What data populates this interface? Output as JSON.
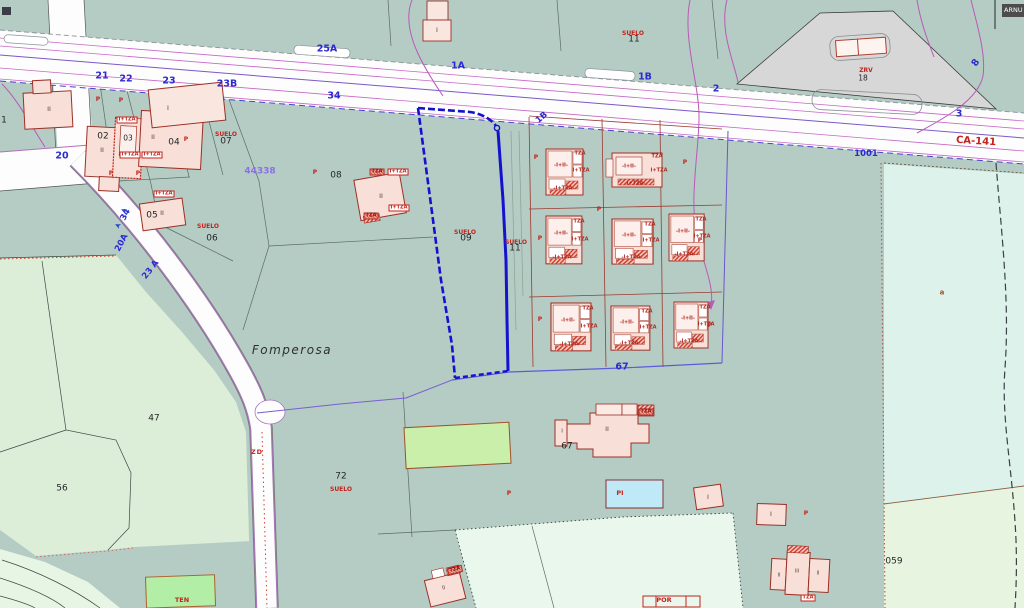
{
  "map": {
    "corner_tag": "ARNU",
    "place": "Fomperosa",
    "ref_code": "44338",
    "road_name": "CA-141",
    "suelo": "SUELO",
    "blue": [
      "25A",
      "21",
      "22",
      "23",
      "23B",
      "34",
      "1A",
      "1B",
      "2",
      "8",
      "3",
      "1001",
      "20",
      "34",
      "20A",
      "23 A",
      "1B",
      "67"
    ],
    "black": [
      "02",
      "03",
      "04",
      "05",
      "06",
      "07",
      "08",
      "09",
      "11",
      "11",
      "18",
      "47",
      "56",
      "67",
      "72",
      "059",
      "1"
    ],
    "red": {
      "zrv": "ZRV",
      "zd": "ZD",
      "ten": "TEN",
      "pi": "PI",
      "por": "POR",
      "a": "a",
      "p": "P"
    },
    "tags": {
      "itza": "I+TZA",
      "tza": "TZA",
      "unit_main": "-I+II-",
      "unit_bottom": "-I+TZA-"
    },
    "roman": [
      "II",
      "II",
      "II",
      "I",
      "II",
      "II",
      "II",
      "I",
      "I",
      "I",
      "II",
      "III",
      "II",
      "II",
      "I"
    ],
    "icons": {
      "flow_arrow": "➤"
    },
    "colors": {
      "selection": "#1512cf",
      "building_fill": "#f8e0d8",
      "building_stroke": "#9c2f26",
      "teal": "#b4ccc4"
    }
  }
}
